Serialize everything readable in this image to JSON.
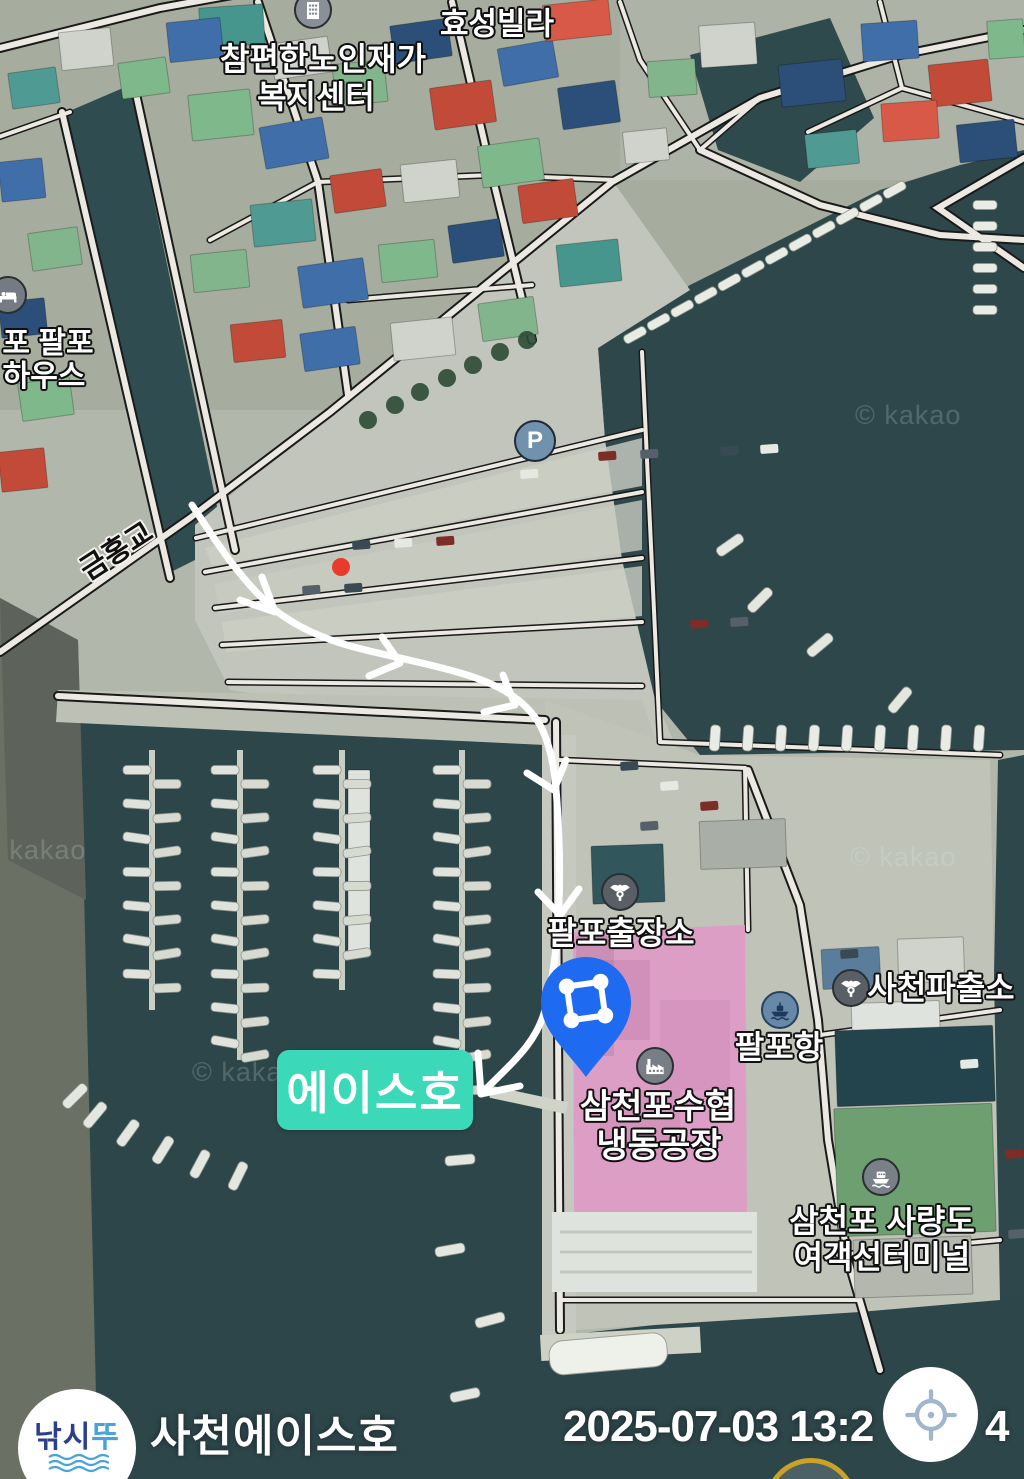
{
  "map": {
    "attribution": "© kakao",
    "labels": {
      "villa": "효성빌라",
      "welfare_center_line1": "참편한노인재가",
      "welfare_center_line2": "복지센터",
      "guesthouse_line1": "포 팔포",
      "guesthouse_line2": "하우스",
      "bridge": "금홍교",
      "parking_letter": "P",
      "palpo_branch_office": "팔포출장소",
      "sacheon_police": "사천파출소",
      "palpo_port": "팔포항",
      "fisheries_line1": "삼천포수협",
      "fisheries_line2": "냉동공장",
      "ferry_terminal_line1": "삼천포 사량도",
      "ferry_terminal_line2": "여객선터미널",
      "destination": "에이스호"
    }
  },
  "footer": {
    "logo_part1": "낚시",
    "logo_part2": "뚜",
    "title": "사천에이스호",
    "timestamp_prefix": "2025-07-03 13:2",
    "timestamp_suffix": "4"
  },
  "colors": {
    "destination_bg": "#3bd9b7",
    "pin": "#1e6af0",
    "route": "#ffffff",
    "highlight_pink": "#e09bc6",
    "water": "#2e474b"
  }
}
